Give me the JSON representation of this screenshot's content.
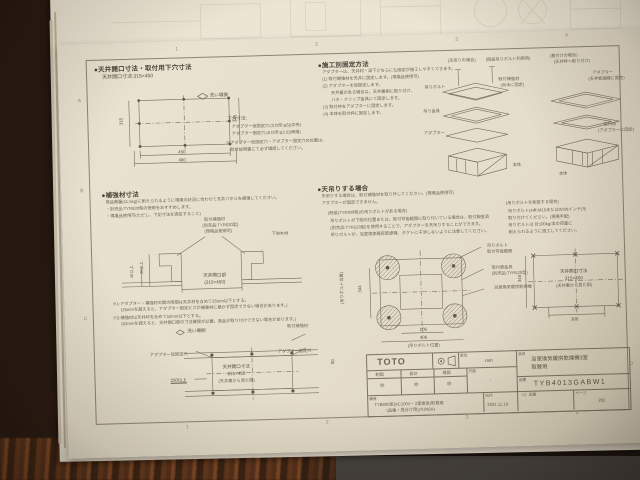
{
  "page": {
    "grid_refs": {
      "top": [
        "1",
        "2",
        "3",
        "4"
      ],
      "bottom": [
        "1",
        "2",
        "3",
        "4"
      ],
      "left": [
        "A",
        "B",
        "C"
      ],
      "right": [
        "D"
      ]
    },
    "sec_opening": {
      "heading": "●天井開口寸法・取付用下穴寸法",
      "subheading": "天井開口寸法:315×450",
      "wash_side": "洗い場側",
      "dims": {
        "inner_w": "450",
        "outer_w": "480",
        "inner_h": "315",
        "outer_h": "345"
      },
      "notes_title": "下穴寸法:",
      "notes": [
        "アダプター仮固定穴:(2カ所:φ6)(中央)",
        "アダプター固定穴:(6カ所:φ3.5)(両端)",
        "※アダプター仮固定穴・アダプター固定穴の位置は、",
        "　取付説明書にて必ず確認してください。"
      ]
    },
    "sec_fixing": {
      "heading": "●施工別固定方法",
      "lines": [
        "アダプターは、天井材・梁下どちらにも固定が施工しやすくできます。",
        "(1) 取付補強材を天井に固定します。(現場品使用可)",
        "(2) アダプターを仮固定します。",
        "　　天井裏がある場合は、天井裏側に取り付け、",
        "　　バネ・クリップ金具にて固定します。",
        "(3) 取付枠をアダプターに固定します。",
        "(4) 本体を取付枠に固定します。"
      ]
    },
    "sec_iso": {
      "caption_left": "(天吊りの場合)",
      "caption_left_sub": "(既設吊りボルト利用時)",
      "caption_right": "(直付けの場合)",
      "caption_right_sub": "(天井枠へ取り付け)",
      "labels": {
        "bolt": "吊りボルト",
        "reinf": "取付補強材",
        "reinf_sub": "(吊木に固定)",
        "hanger": "吊り金具",
        "adapter_l": "アダプター",
        "body_l": "本体",
        "adapter_r": "アダプター",
        "adapter_r_sub": "(天井板廻縁に固定)",
        "frame_r": "取付枠",
        "frame_r_sub": "(アダプターに固定)",
        "body_r": "本体"
      }
    },
    "sec_reinforce": {
      "heading": "●補強材寸法",
      "lines": [
        "商品質量(11.5kg)に耐えられるように現場の状況に合わせて天井パネルを補強してください。",
        "・別売品:TYR630型の使用をおすすめします。",
        "・現場品使用可(ただし、下記寸法を満足すること)"
      ],
      "label_reinf": "取付補強材",
      "label_reinf_sub1": "(別売品:TYR630型)",
      "label_reinf_sub2": "(現場品使用可)",
      "label_joist": "下地木材",
      "opening_label": "天井開口部",
      "opening_size": "(315×450)",
      "dim_a": "25以上",
      "dim_b": "40以上",
      "notes": [
        "※1:アダプター・補強材の間の隙間は天井材を含めて25mm以下とする。",
        "　　(25mmを超えると、アダプター固定ビスが補強材に届かず固定できない場合があります。)",
        "※2:補強材は天井材を含めて52mm以下とする。",
        "　　(52mmを超えると、天井開口部の寸法確保が必要。商品が取り付けできない場合があります。)"
      ]
    },
    "sec_bottomleft": {
      "wash_side": "洗い場側",
      "label_reinf": "取付補強材",
      "label_hole_l": "アダプター仮固定穴",
      "label_hole_r": "アダプター固定穴",
      "center1": "天井開口寸法",
      "center2": "315×450",
      "center3": "(天井裏から見た図)",
      "dim_left": "250以上",
      "dim_right": "50"
    },
    "sec_ceiling": {
      "heading": "●天吊りする場合",
      "lines": [
        "天吊りする場合は、取付補強材を取り外してください。(現場品使用可)",
        "アダプターが固定できません。"
      ],
      "sub1_title": "(既設(TYK900型)の吊りボルトがある場合)",
      "sub1_lines": [
        "吊りボルトが下図の位置または、取付可能範囲に取り付いている場合は、取付脚金具",
        "(別売品:TYR520型)を使用することで、アダプターを天吊りすることができます。",
        "吊りボルトが、浴室換気暖房乾燥機、ダクトに干渉しないように注意してください。"
      ],
      "sub2_title": "(吊りボルトを新設する場合)",
      "sub2_lines": [
        "吊りボルト(4本:M10またはW3/8インチ)を",
        "取り付けてください。(現場手配)",
        "吊りボルトは 計100kg/本の荷重に",
        "耐えられるように施工してください。"
      ]
    },
    "sec_boltplan": {
      "label1": "吊りボルト",
      "label2": "取付可能範囲",
      "label3": "取付脚金具",
      "label4": "(別売品:TYR520型)",
      "label5": "浴室換気暖房乾燥機",
      "dim_206": "206",
      "dim_406": "406",
      "note_bottom": "(吊りボルト位置)",
      "dim_344": "344",
      "note_left": "(吊りボルト位置)"
    },
    "sec_openplan": {
      "center1": "天井開口寸法",
      "center2": "315×450",
      "center3": "(天井裏から見た図)",
      "dim_left": "345",
      "dim_bottom": "306"
    },
    "title_block": {
      "logo": "TOTO",
      "unit_label": "単位",
      "unit_value": "mm",
      "scale_label": "尺度",
      "scale_value": "-",
      "col_headers": [
        "制図",
        "設計",
        "検図"
      ],
      "stamps": [
        "㊞",
        "㊞",
        "㊞"
      ],
      "name_label": "品名",
      "name_line1": "浴室換気暖房乾燥機3室",
      "name_line2": "取替用",
      "code_label": "品番",
      "code_value": "TYB4013GABW1",
      "remarks_label": "備考",
      "remarks_line1": "TYB800型(AC100V・3室換気)取替用",
      "remarks_line2": "(品番・見分け用)(7UN6A)",
      "date_label": "日付",
      "date_value": "2021.11.19",
      "fig_label": "〈1〉図番",
      "page_label": "ページ",
      "page_value": "2/3"
    }
  }
}
